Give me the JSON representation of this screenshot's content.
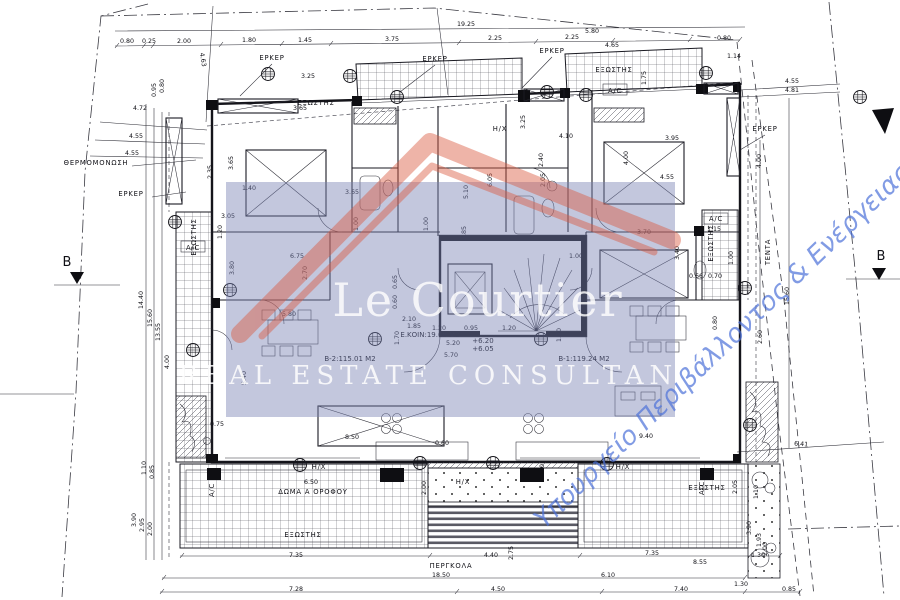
{
  "watermark": {
    "title": "Le Courtier",
    "subtitle": "REAL ESTATE CONSULTANTS",
    "ministry_text": "Υπουργείο Περιβάλλοντος & Ενέργειας",
    "overlay_color": "#7b82b4",
    "logo_color": "#da5a41",
    "title_color": "#ffffff",
    "ministry_color": "#4d72d9"
  },
  "plan": {
    "section_label": "B",
    "dims": [
      {
        "t": "19.25",
        "x": 466,
        "y": 26
      },
      {
        "t": "0.80",
        "x": 127,
        "y": 43
      },
      {
        "t": "0.25",
        "x": 149,
        "y": 43
      },
      {
        "t": "2.00",
        "x": 184,
        "y": 43
      },
      {
        "t": "1.80",
        "x": 249,
        "y": 42
      },
      {
        "t": "1.45",
        "x": 305,
        "y": 42
      },
      {
        "t": "3.75",
        "x": 392,
        "y": 41
      },
      {
        "t": "2.25",
        "x": 495,
        "y": 40
      },
      {
        "t": "2.25",
        "x": 572,
        "y": 39
      },
      {
        "t": "5.80",
        "x": 592,
        "y": 33
      },
      {
        "t": "4.65",
        "x": 612,
        "y": 47
      },
      {
        "t": "0.80",
        "x": 724,
        "y": 40
      },
      {
        "t": "1.14",
        "x": 734,
        "y": 58
      },
      {
        "t": "1.75",
        "x": 646,
        "y": 78,
        "r": -90
      },
      {
        "t": "4.63",
        "x": 201,
        "y": 60,
        "r": 80
      },
      {
        "t": "0.95",
        "x": 156,
        "y": 90,
        "r": -90
      },
      {
        "t": "0.80",
        "x": 164,
        "y": 86,
        "r": -90
      },
      {
        "t": "3.25",
        "x": 308,
        "y": 78
      },
      {
        "t": "4.55",
        "x": 792,
        "y": 83
      },
      {
        "t": "4.81",
        "x": 792,
        "y": 92
      },
      {
        "t": "4.72",
        "x": 140,
        "y": 110
      },
      {
        "t": "4.55",
        "x": 136,
        "y": 138
      },
      {
        "t": "4.55",
        "x": 132,
        "y": 155
      },
      {
        "t": "14.40",
        "x": 143,
        "y": 300,
        "r": -90
      },
      {
        "t": "15.60",
        "x": 152,
        "y": 318,
        "r": -90
      },
      {
        "t": "13.55",
        "x": 160,
        "y": 332,
        "r": -90
      },
      {
        "t": "2.35",
        "x": 212,
        "y": 172,
        "r": -90
      },
      {
        "t": "4.00",
        "x": 169,
        "y": 362,
        "r": -90
      },
      {
        "t": "5.40",
        "x": 246,
        "y": 378,
        "r": -90
      },
      {
        "t": "1.10",
        "x": 146,
        "y": 468,
        "r": -90
      },
      {
        "t": "0.85",
        "x": 154,
        "y": 472,
        "r": -90
      },
      {
        "t": "3.90",
        "x": 136,
        "y": 520,
        "r": -90
      },
      {
        "t": "2.95",
        "x": 144,
        "y": 525,
        "r": -90
      },
      {
        "t": "2.00",
        "x": 152,
        "y": 529,
        "r": -90
      },
      {
        "t": "0.75",
        "x": 217,
        "y": 426
      },
      {
        "t": "3.65",
        "x": 300,
        "y": 110
      },
      {
        "t": "3.65",
        "x": 233,
        "y": 163,
        "r": -90
      },
      {
        "t": "1.40",
        "x": 249,
        "y": 190
      },
      {
        "t": "3.05",
        "x": 228,
        "y": 218
      },
      {
        "t": "6.75",
        "x": 297,
        "y": 258
      },
      {
        "t": "2.70",
        "x": 307,
        "y": 273,
        "r": -90
      },
      {
        "t": "3.80",
        "x": 234,
        "y": 268,
        "r": -90
      },
      {
        "t": "5.80",
        "x": 289,
        "y": 316
      },
      {
        "t": "1.00",
        "x": 358,
        "y": 224,
        "r": -90
      },
      {
        "t": "1.00",
        "x": 428,
        "y": 224,
        "r": -90
      },
      {
        "t": "1.85",
        "x": 466,
        "y": 233,
        "r": -90
      },
      {
        "t": "5.10",
        "x": 468,
        "y": 192,
        "r": -90
      },
      {
        "t": "3.65",
        "x": 352,
        "y": 194
      },
      {
        "t": "4.10",
        "x": 566,
        "y": 138
      },
      {
        "t": "3.95",
        "x": 672,
        "y": 140
      },
      {
        "t": "2.40",
        "x": 543,
        "y": 160,
        "r": -90
      },
      {
        "t": "4.00",
        "x": 628,
        "y": 158,
        "r": -90
      },
      {
        "t": "4.55",
        "x": 667,
        "y": 179
      },
      {
        "t": "3.70",
        "x": 644,
        "y": 234
      },
      {
        "t": "3.40",
        "x": 679,
        "y": 253,
        "r": -90
      },
      {
        "t": "1.00",
        "x": 733,
        "y": 258,
        "r": -90
      },
      {
        "t": "1.00",
        "x": 576,
        "y": 258
      },
      {
        "t": "6.05",
        "x": 492,
        "y": 180,
        "r": -90
      },
      {
        "t": "0.80",
        "x": 717,
        "y": 323,
        "r": -90
      },
      {
        "t": "1.15",
        "x": 714,
        "y": 231
      },
      {
        "t": "0.66",
        "x": 696,
        "y": 278
      },
      {
        "t": "0.70",
        "x": 715,
        "y": 278
      },
      {
        "t": "0.65",
        "x": 397,
        "y": 282,
        "r": -90
      },
      {
        "t": "0.60",
        "x": 397,
        "y": 302,
        "r": -90
      },
      {
        "t": "2.10",
        "x": 409,
        "y": 321
      },
      {
        "t": "1.85",
        "x": 414,
        "y": 328
      },
      {
        "t": "1.20",
        "x": 439,
        "y": 330
      },
      {
        "t": "0.95",
        "x": 471,
        "y": 330
      },
      {
        "t": "1.20",
        "x": 509,
        "y": 330
      },
      {
        "t": "1.70",
        "x": 399,
        "y": 338,
        "r": -90
      },
      {
        "t": "1.70",
        "x": 561,
        "y": 335,
        "r": -90
      },
      {
        "t": "5.20",
        "x": 453,
        "y": 345
      },
      {
        "t": "5.70",
        "x": 451,
        "y": 357
      },
      {
        "t": "8.50",
        "x": 352,
        "y": 439
      },
      {
        "t": "9.40",
        "x": 646,
        "y": 438
      },
      {
        "t": "0.60",
        "x": 442,
        "y": 445
      },
      {
        "t": "6.50",
        "x": 311,
        "y": 484
      },
      {
        "t": "2.00",
        "x": 426,
        "y": 488,
        "r": -90
      },
      {
        "t": "2.75",
        "x": 513,
        "y": 553,
        "r": -90
      },
      {
        "t": "0.90",
        "x": 544,
        "y": 471,
        "r": -90
      },
      {
        "t": "2.05",
        "x": 737,
        "y": 487,
        "r": -90
      },
      {
        "t": "7.35",
        "x": 296,
        "y": 557
      },
      {
        "t": "4.40",
        "x": 491,
        "y": 557
      },
      {
        "t": "7.35",
        "x": 652,
        "y": 555
      },
      {
        "t": "8.55",
        "x": 700,
        "y": 564
      },
      {
        "t": "1.30",
        "x": 758,
        "y": 557
      },
      {
        "t": "18.50",
        "x": 441,
        "y": 577
      },
      {
        "t": "6.10",
        "x": 608,
        "y": 577
      },
      {
        "t": "7.28",
        "x": 296,
        "y": 591
      },
      {
        "t": "4.50",
        "x": 498,
        "y": 591
      },
      {
        "t": "7.40",
        "x": 681,
        "y": 591
      },
      {
        "t": "0.85",
        "x": 789,
        "y": 591
      },
      {
        "t": "6.41",
        "x": 801,
        "y": 446,
        "r": 4
      },
      {
        "t": "15.60",
        "x": 789,
        "y": 296,
        "r": -90
      },
      {
        "t": "4.00",
        "x": 761,
        "y": 161,
        "r": -90
      },
      {
        "t": "1.10",
        "x": 758,
        "y": 492,
        "r": -90
      },
      {
        "t": "3.90",
        "x": 751,
        "y": 528,
        "r": -90
      },
      {
        "t": "1.93",
        "x": 761,
        "y": 540,
        "r": -90
      },
      {
        "t": "2.00",
        "x": 767,
        "y": 549,
        "r": -90
      },
      {
        "t": "1.30",
        "x": 741,
        "y": 586
      },
      {
        "t": "2.60",
        "x": 762,
        "y": 337,
        "r": -90
      },
      {
        "t": "3.25",
        "x": 525,
        "y": 122,
        "r": -90
      },
      {
        "t": "1.20",
        "x": 222,
        "y": 232,
        "r": -90
      },
      {
        "t": "2.05",
        "x": 545,
        "y": 180,
        "r": -90
      }
    ],
    "labels": [
      {
        "t": "ΕΡΚΕΡ",
        "x": 272,
        "y": 60
      },
      {
        "t": "ΕΡΚΕΡ",
        "x": 435,
        "y": 61
      },
      {
        "t": "ΕΡΚΕΡ",
        "x": 552,
        "y": 53
      },
      {
        "t": "ΕΡΚΕΡ",
        "x": 131,
        "y": 196
      },
      {
        "t": "ΕΡΚΕΡ",
        "x": 765,
        "y": 131
      },
      {
        "t": "ΘΕΡΜΟΜΟΝΩΣΗ",
        "x": 96,
        "y": 165
      },
      {
        "t": "ΕΞΩΣΤΗΣ",
        "x": 316,
        "y": 105
      },
      {
        "t": "ΕΞΩΣΤΗΣ",
        "x": 614,
        "y": 72
      },
      {
        "t": "ΕΞΩΣΤΗΣ",
        "x": 196,
        "y": 237,
        "r": -90
      },
      {
        "t": "ΕΞΩΣΤΗΣ",
        "x": 713,
        "y": 243,
        "r": -90
      },
      {
        "t": "ΕΞΩΣΤΗΣ",
        "x": 303,
        "y": 537
      },
      {
        "t": "ΕΞΩΣΤΗΣ",
        "x": 707,
        "y": 490
      },
      {
        "t": "ΠΕΡΓΚΟΛΑ",
        "x": 451,
        "y": 568
      },
      {
        "t": "ΔΩΜΑ Α ΟΡΟΦΟΥ",
        "x": 313,
        "y": 494
      },
      {
        "t": "Η/Χ",
        "x": 319,
        "y": 469
      },
      {
        "t": "Η/Χ",
        "x": 463,
        "y": 484
      },
      {
        "t": "Η/Χ",
        "x": 623,
        "y": 469
      },
      {
        "t": "Η/Χ",
        "x": 500,
        "y": 131
      },
      {
        "t": "A/C",
        "x": 615,
        "y": 93
      },
      {
        "t": "A/C",
        "x": 193,
        "y": 250
      },
      {
        "t": "A/C",
        "x": 716,
        "y": 221
      },
      {
        "t": "A/C",
        "x": 214,
        "y": 490,
        "r": -90
      },
      {
        "t": "A/C",
        "x": 704,
        "y": 488,
        "r": -90
      },
      {
        "t": "ΤΕΝΤΑ",
        "x": 770,
        "y": 252,
        "r": -90
      },
      {
        "t": "B",
        "x": 67,
        "y": 266,
        "c": "secB"
      },
      {
        "t": "B",
        "x": 881,
        "y": 260,
        "c": "secB"
      }
    ],
    "areas": [
      {
        "t": "Ε.ΚΟΙΝ:19.68 Μ2",
        "x": 430,
        "y": 337
      },
      {
        "t": "Β-2:115.01 Μ2",
        "x": 350,
        "y": 361
      },
      {
        "t": "Β-1:119.24 Μ2",
        "x": 584,
        "y": 361
      },
      {
        "t": "+6.20",
        "x": 483,
        "y": 343
      },
      {
        "t": "+6.05",
        "x": 483,
        "y": 351
      }
    ]
  }
}
